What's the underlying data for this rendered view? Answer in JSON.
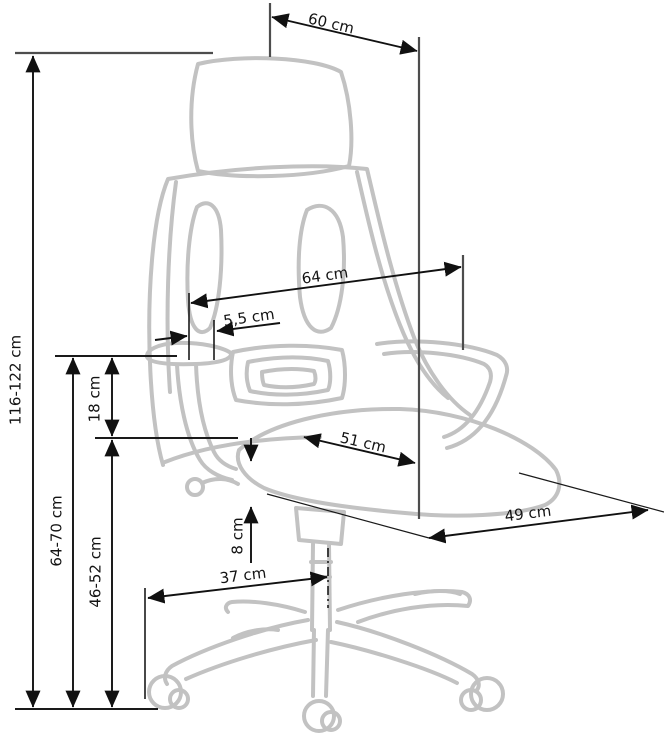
{
  "diagram": {
    "type": "technical-dimension-drawing",
    "subject": "office swivel chair with headrest, side view",
    "unit": "cm",
    "dimensions": {
      "headrest_width": {
        "label": "60 cm",
        "value": 60
      },
      "total_height": {
        "label": "116-122 cm",
        "min": 116,
        "max": 122
      },
      "backrest_width": {
        "label": "64 cm",
        "value": 64
      },
      "armrest_offset": {
        "label": "5,5 cm",
        "value": 5.5
      },
      "armrest_above_seat": {
        "label": "18 cm",
        "value": 18
      },
      "seat_depth": {
        "label": "51 cm",
        "value": 51
      },
      "seat_width": {
        "label": "49 cm",
        "value": 49
      },
      "armrest_height": {
        "label": "64-70 cm",
        "min": 64,
        "max": 70
      },
      "seat_height": {
        "label": "46-52 cm",
        "min": 46,
        "max": 52
      },
      "seat_thickness": {
        "label": "8 cm",
        "value": 8
      },
      "base_leg_reach": {
        "label": "37 cm",
        "value": 37
      }
    },
    "colors": {
      "background": "#ffffff",
      "dimension_lines": "#1a1a1a",
      "extension_lines": "#4d4d4d",
      "chair_outline": "#c2c2c2"
    }
  }
}
